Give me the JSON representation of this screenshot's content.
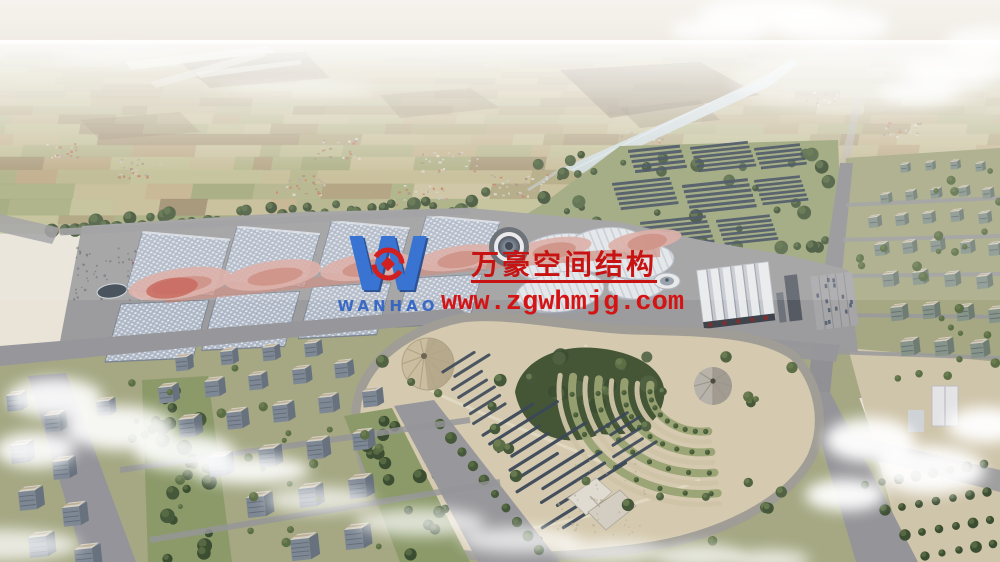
{
  "image": {
    "description": "Aerial architectural rendering of a large exhibition center complex with rows of vaulted halls under pink wavy canopies, a central glass dome, a white pleated-roof hall, solar panel fields, a landscaped park with cone tents and terraced gardens, surrounded by city blocks and distant farmland stretching to a hazy horizon",
    "type": "architectural-rendering"
  },
  "watermark": {
    "logo_letter": "W",
    "logo_subtext": "WANHAO",
    "company_name": "万豪空间结构",
    "website": "www.zgwhmjg.com",
    "colors": {
      "logo_blue": "#3a74d2",
      "logo_blue_dark": "#1c478f",
      "logo_red": "#d21f1f",
      "text_red": "#c81313"
    }
  },
  "palette": {
    "skyTop": "#f5f2ec",
    "skyBottom": "#e9e3d8",
    "farmBase": "#c3b992",
    "farm": [
      "#c8bd97",
      "#b3b487",
      "#a7ad7e",
      "#c2ab84",
      "#9f8a68",
      "#b79d79",
      "#8f7a5c",
      "#bdc092",
      "#ccc4a0",
      "#a3986f"
    ],
    "water": "#ccd8dc",
    "road": "#97979b",
    "roadLight": "#b9b4ac",
    "lawn": "#9aa377",
    "lawnCity": "#a5a883",
    "median": "#8c9a6a",
    "tree1": "#46583a",
    "tree2": "#5b6e45",
    "tree3": "#3c4e32",
    "solar": "#3b4859",
    "plaza": "#9c9b9d",
    "hallRoof": "#adb6c4",
    "hallEdge": "#77808e",
    "canopyPink": "#d8a79e",
    "canopyMid": "#c88274",
    "canopyRed": "#c2564a",
    "whiteRoof": "#e2e5e9",
    "sawtooth": "#e8eaec",
    "parkGround": "#d5caaf",
    "parkPath": "#e3dbc4",
    "coneTan": "#cabda0",
    "coneGrey": "#b7b2aa",
    "bldFront": "#7e8894",
    "bldSide": "#68727e",
    "bldRoof": "#d6d1c6",
    "bldRoofTan": "#bcae94",
    "bldWin": "#59636f",
    "bldFrontR": "#87948a",
    "bldSideR": "#6f7c74",
    "tanGround": "#cfc5ab",
    "cloud": "#ffffff"
  }
}
